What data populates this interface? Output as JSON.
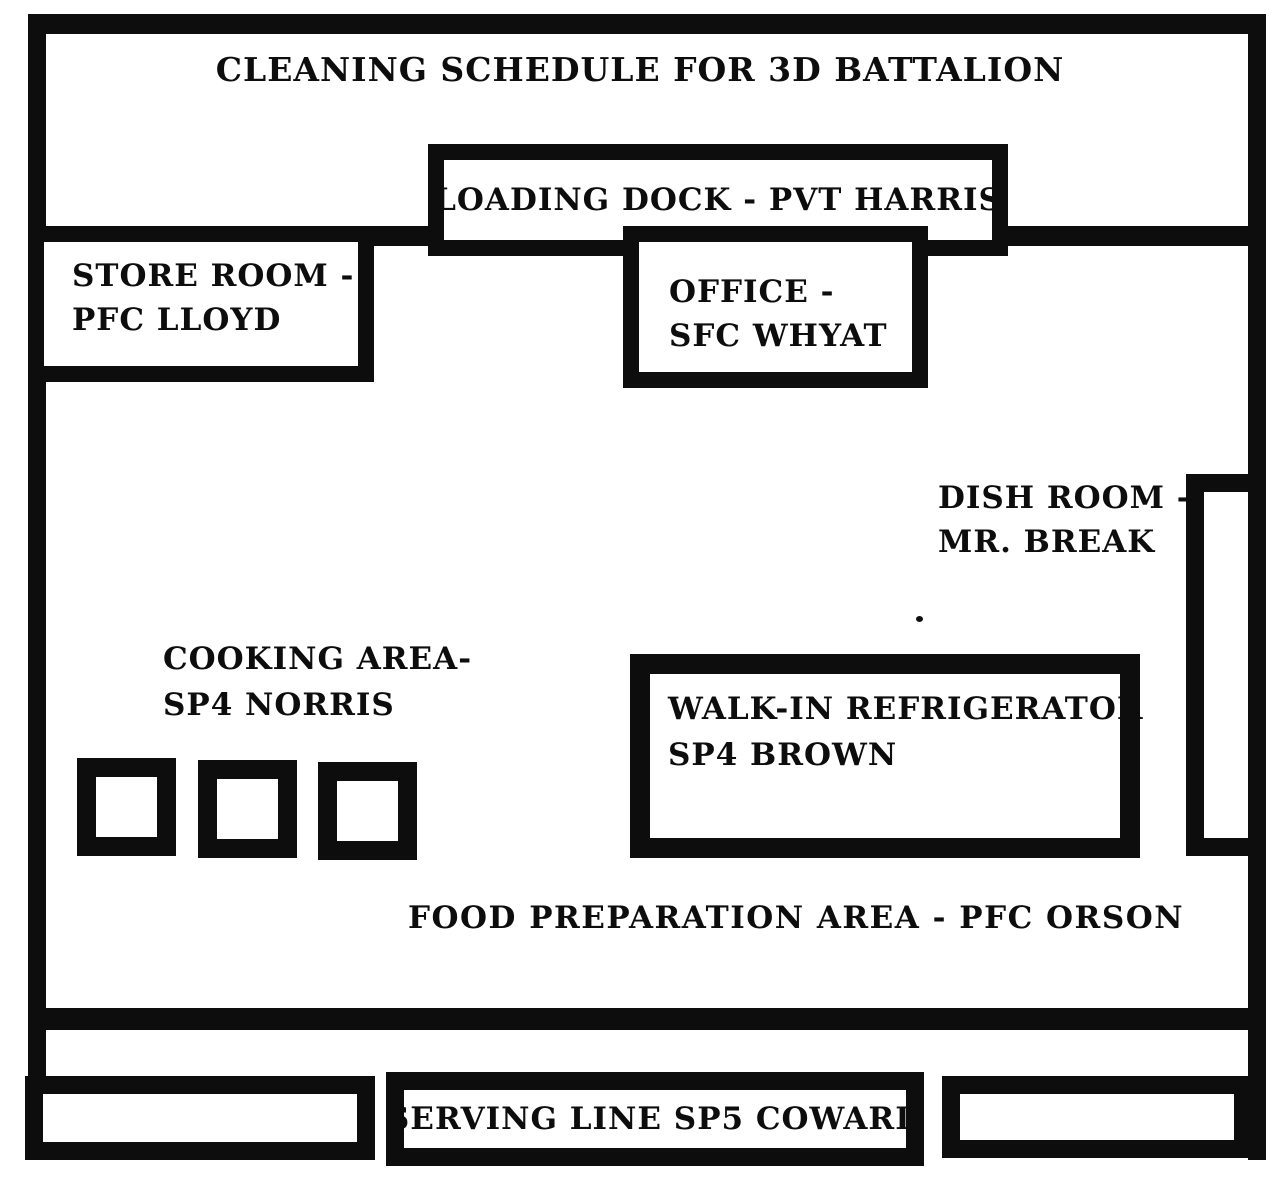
{
  "title": "CLEANING SCHEDULE FOR 3D BATTALION",
  "rooms": {
    "loading_dock": {
      "label": "LOADING DOCK - PVT HARRIS"
    },
    "store_room": {
      "line1": "STORE ROOM -",
      "line2": "PFC LLOYD"
    },
    "office": {
      "line1": "OFFICE -",
      "line2": "SFC WHYAT"
    },
    "dish_room": {
      "line1": "DISH ROOM -",
      "line2": "MR. BREAK"
    },
    "cooking_area": {
      "line1": "COOKING AREA-",
      "line2": "SP4 NORRIS"
    },
    "walk_in_refrigerator": {
      "line1": "WALK-IN REFRIGERATOR",
      "line2": "SP4 BROWN"
    },
    "food_preparation_area": {
      "label": "FOOD PREPARATION AREA - PFC ORSON"
    },
    "serving_line": {
      "label": "SERVING LINE SP5 COWARD"
    }
  },
  "equipment": {
    "cooking_square_count": 3
  },
  "colors": {
    "ink": "#0d0d0d",
    "background": "#ffffff"
  }
}
